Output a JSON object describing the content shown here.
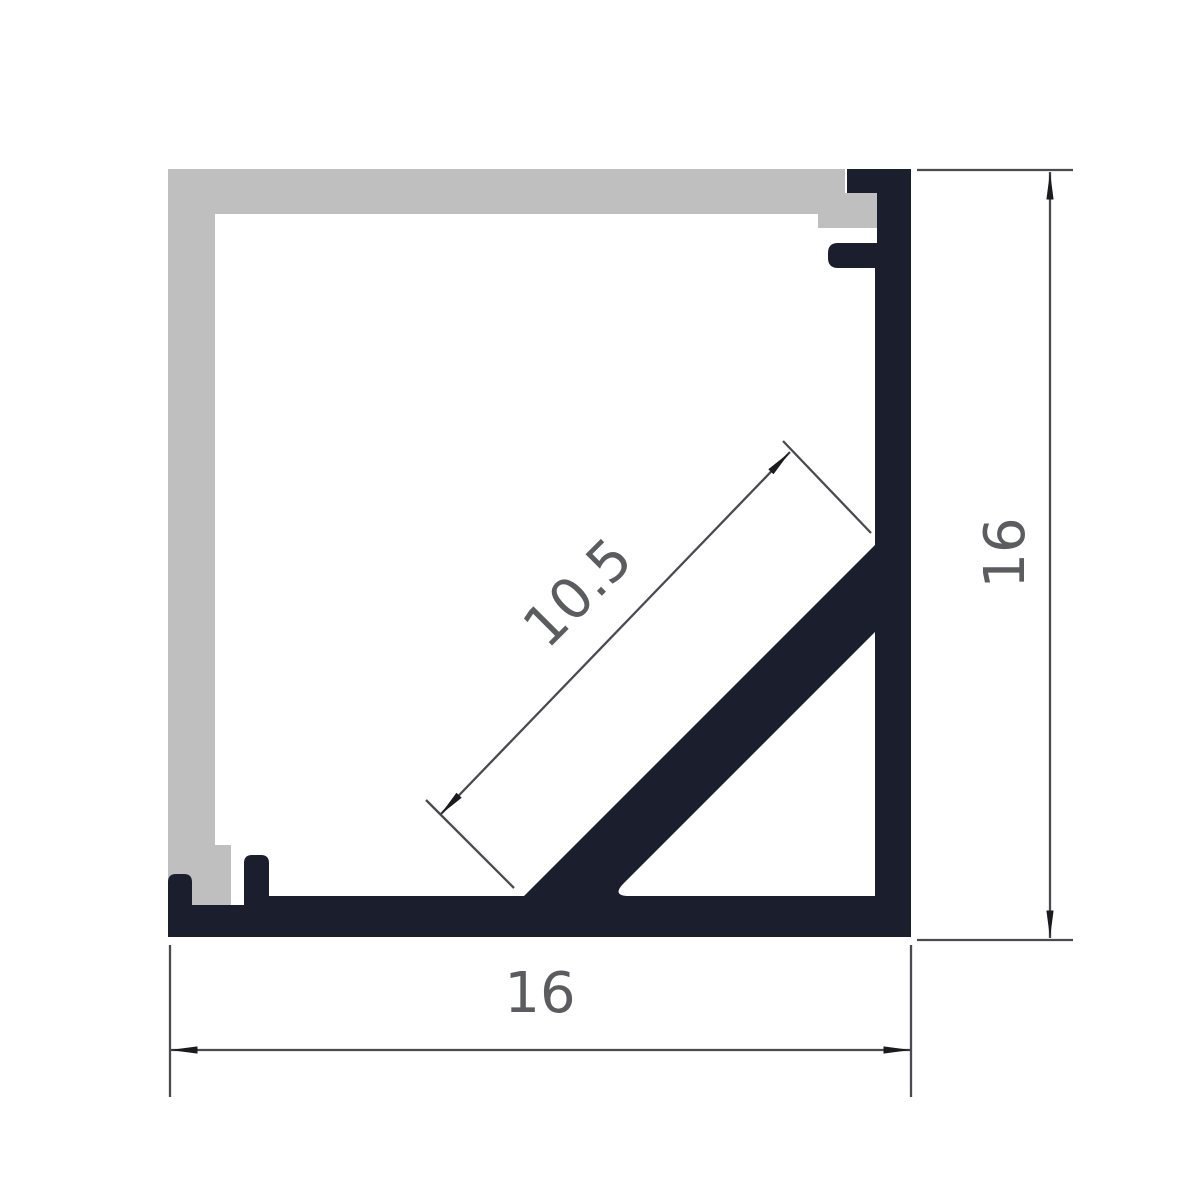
{
  "drawing": {
    "kind": "technical cross-section drawing",
    "subject": "corner aluminium LED profile with diffuser cover",
    "background": "#ffffff"
  },
  "colors": {
    "profile": "#1b1f2d",
    "diffuser": "#bfbfbf",
    "dimension_line": "#4a4b50",
    "arrowhead": "#1a1a1f",
    "dimension_text": "#5b5c60"
  },
  "parts": {
    "diffuser": {
      "label": "diffuser-cover",
      "path": "M168,169 H845 V193 H877 V228 H818 V214 H215 V845 H231 V905 H168 Z"
    },
    "profile": {
      "label": "aluminium-profile",
      "path": "M847,169 H911 V937 H168 V882 Q168,874 176,874 H184 Q192,874 192,882 V905 H244 V863 Q244,855 252,855 H261 Q269,855 269,863 V896 H524 L875,545 V268 H838 Q828,268 828,258 V253 Q828,243 838,243 H877 V193 H847 Z M875,632 L624,883 Q611,896 629,896 H875 Z"
    }
  },
  "dimensions": {
    "overall_width": {
      "value": "16",
      "ext_a": "M170,945 V1097",
      "ext_b": "M911,945 V1097",
      "line": "M170,1050 H911",
      "label_transform": "translate(540,992)"
    },
    "overall_height": {
      "value": "16",
      "ext_a": "M917,170 H1073",
      "ext_b": "M917,940 H1073",
      "line": "M1050,172 V938",
      "label_transform": "translate(1004,553) rotate(-90)"
    },
    "channel_opening": {
      "value": "10.5",
      "ext_a": "M426,800 L514,888",
      "ext_b": "M783,441 L871,533",
      "line": "M440,815 L790,452",
      "label_transform": "translate(577,592) rotate(-45)"
    }
  }
}
